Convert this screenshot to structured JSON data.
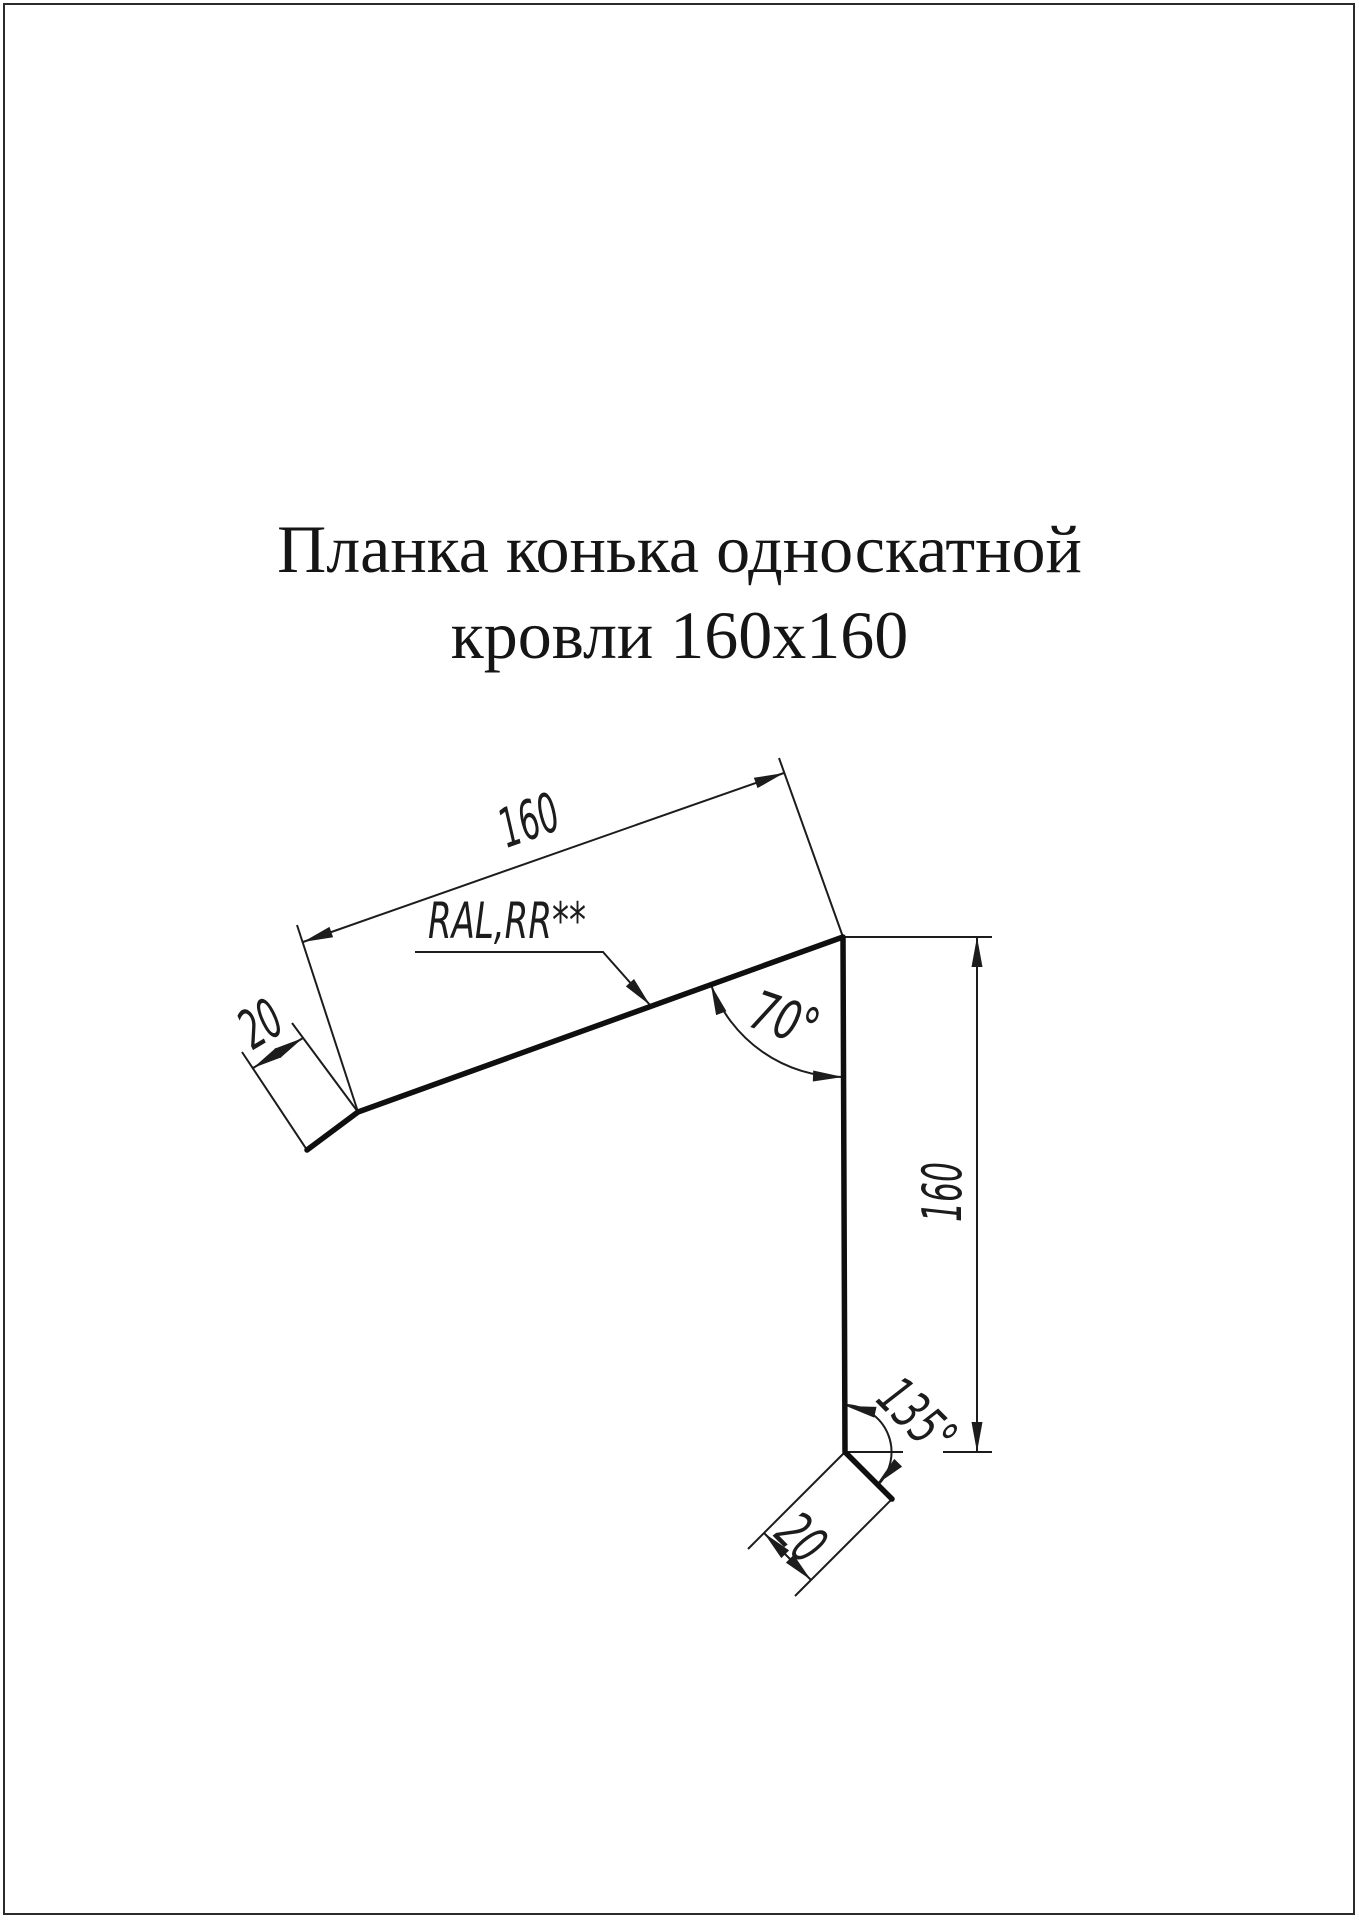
{
  "sheet": {
    "title_line1": "Планка конька односкатной",
    "title_line2": "кровли 160x160"
  },
  "drawing": {
    "labels": {
      "top_width": "160",
      "left_flange_width": "20",
      "apex_angle": "70°",
      "right_height": "160",
      "bottom_angle": "135°",
      "bottom_flange_width": "20",
      "coating": "RAL,RR**"
    },
    "profile": {
      "description_points": "flange-tip-left, bend-left, ridge-corner, bend-bottom, flange-tip-bottom"
    },
    "colors": {
      "ink": "#1c1c1c",
      "profile_ink": "#0f0f0f",
      "paper": "#ffffff",
      "border": "#2b2b2b"
    }
  }
}
